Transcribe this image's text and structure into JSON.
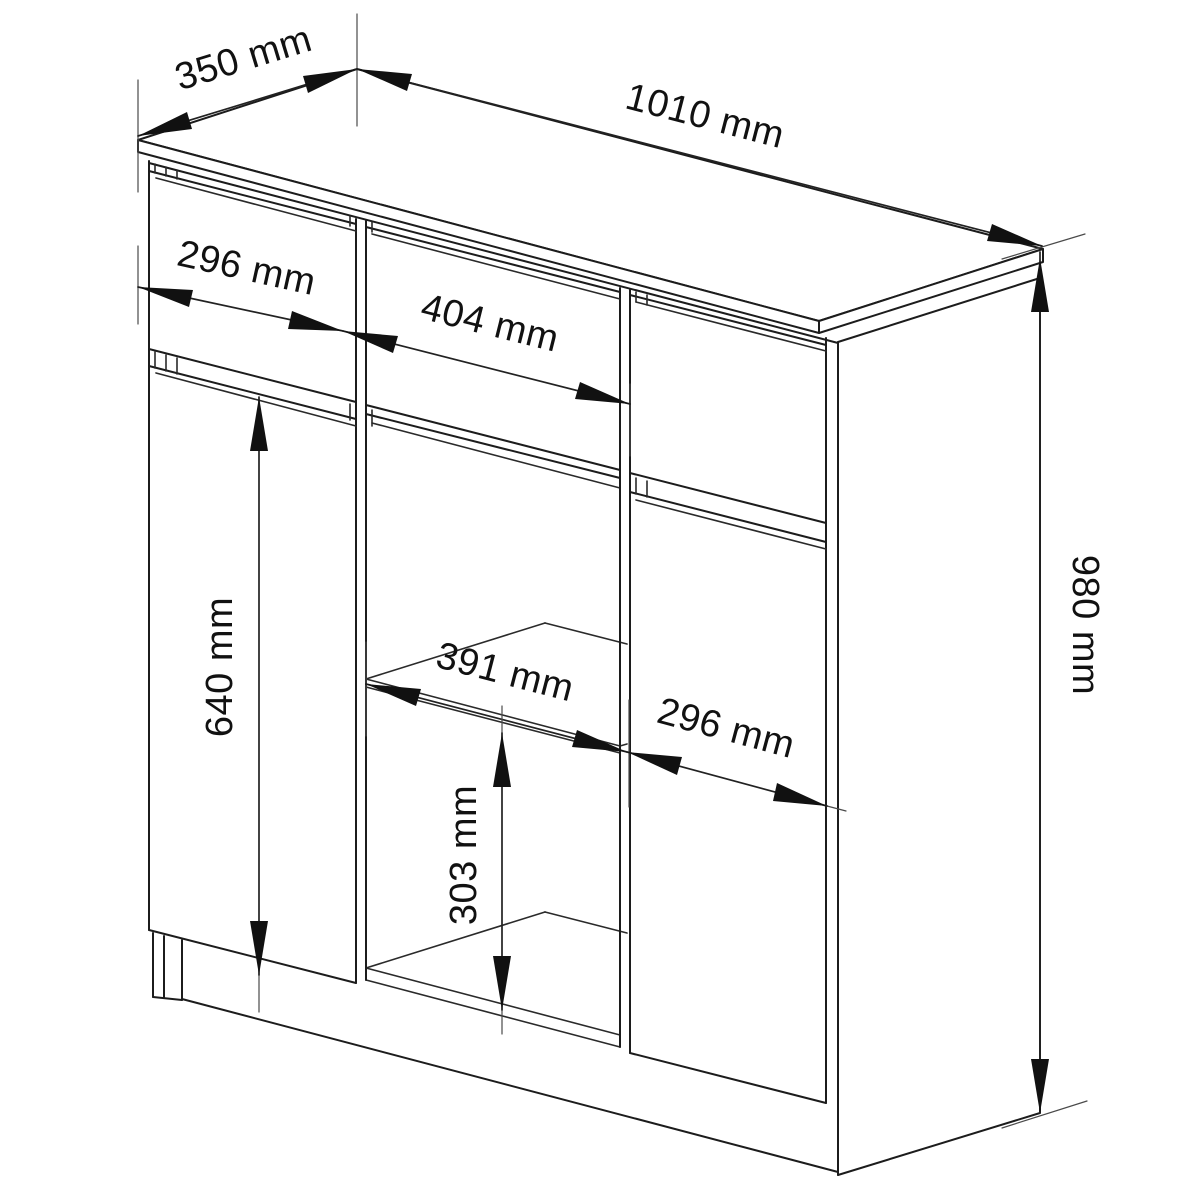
{
  "figure": {
    "title": "Sideboard dimension drawing",
    "description": "Black-and-white isometric line drawing of a sideboard commode with two drawers, two doors and a middle open shelf section, annotated with millimetre dimensions",
    "background_color": "#ffffff",
    "line_color": "#1c1c1c",
    "unit": "mm"
  },
  "dimensions": {
    "top_depth": "350 mm",
    "top_width": "1010 mm",
    "total_height": "980 mm",
    "left_drawer_width": "296 mm",
    "middle_drawer_width": "404 mm",
    "left_door_height": "640 mm",
    "shelf_opening_width": "391 mm",
    "right_door_width": "296 mm",
    "lower_shelf_height": "303 mm"
  }
}
